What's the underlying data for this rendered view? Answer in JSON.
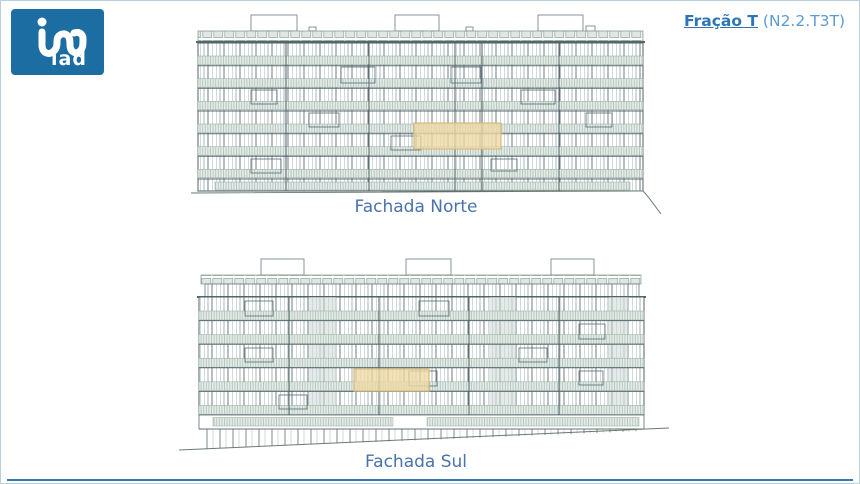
{
  "logo": {
    "brand_text": "iad",
    "brand_color": "#1c6da2"
  },
  "header": {
    "fraction_label": "Fração T",
    "fraction_code": "(N2.2.T3T)",
    "label_color": "#2e75b6",
    "code_color": "#5b9bd5"
  },
  "drawings": {
    "north": {
      "label": "Fachada Norte"
    },
    "south": {
      "label": "Fachada Sul"
    }
  },
  "highlight": {
    "fill": "#eed9a4",
    "border": "#d8bc7a"
  },
  "colors": {
    "facade_label": "#4a72ac",
    "drawing_line_dark": "#4f6066",
    "drawing_line_light": "#b3c2c4",
    "railing_band": "#e4ebe7",
    "bottom_rule": "#3a76b4",
    "page_border": "#b9cfdc"
  }
}
